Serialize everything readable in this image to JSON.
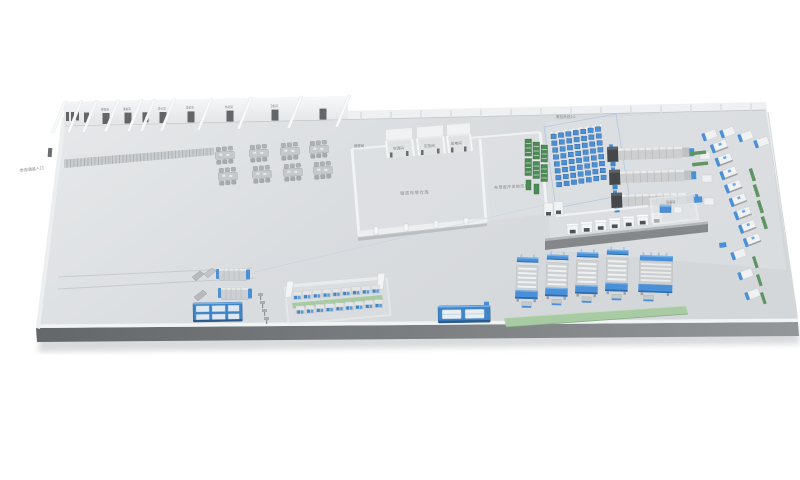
{
  "scene": {
    "type": "3d-isometric-laundry-factory-layout-render",
    "background_color": "#ffffff"
  },
  "labels": {
    "visitor_walkway": "参观通道入口",
    "hanging_system": "悬挂系统3.0",
    "maintenance_room": "维修间",
    "utility_rooms": [
      "空调间",
      "空压间",
      "配电间"
    ],
    "warehouse_hall": "租赁布草仓库",
    "medical_hall": "布草医疗发放区域",
    "equipment_room": "设备间",
    "office_rooms": [
      "更衣间",
      "淋浴间",
      "办公室",
      "会议室",
      "休息间",
      "卫生间"
    ]
  },
  "palette": {
    "floor": "#d9dcde",
    "floor_edge_dark": "#65696c",
    "wall_white": "#f2f3f4",
    "machine_gray": "#ccced0",
    "machine_dark": "#44484b",
    "accent_blue": "#4a90d9",
    "accent_blue_dark": "#2f6cae",
    "rack_green": "#4d8a57",
    "mat_green": "#a9cba4",
    "walkway_dark": "#85888b",
    "label_gray": "#84888b"
  },
  "equipment": {
    "workstation_clusters": 8,
    "hanging_grid_columns": 7,
    "hanging_grid_rows": 8,
    "green_storage_racks": 6,
    "tunnel_washer_lines_right": 3,
    "tunnel_washer_lines_left": 2,
    "wall_washer_extractors": 8,
    "dryers": 7,
    "ironer_folder_lines": 4,
    "towel_folders": 1,
    "compact_washer_rows": 2,
    "compact_washers_per_row": 9,
    "sorting_conveyors": 2,
    "utility_posts": 4
  }
}
